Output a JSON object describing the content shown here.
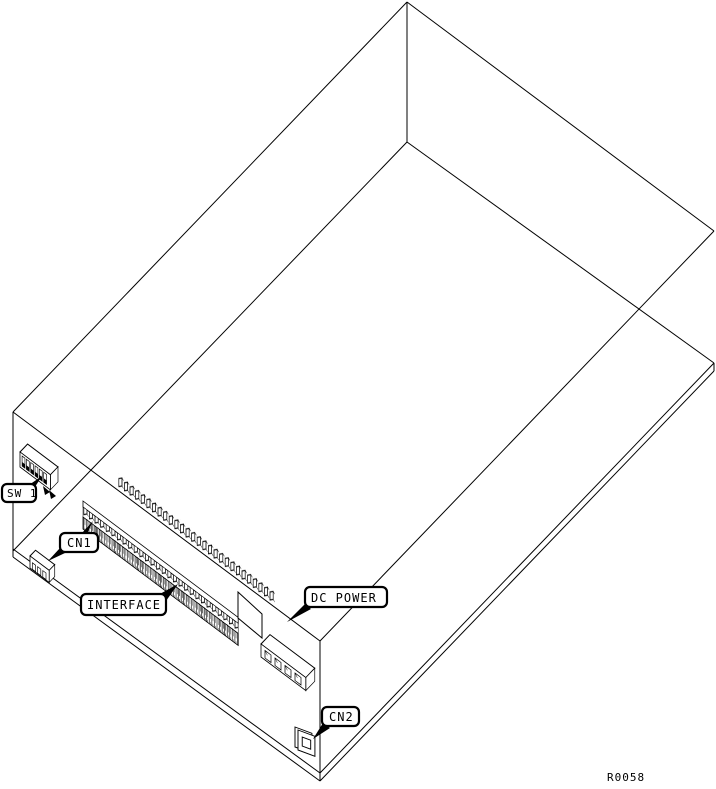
{
  "diagram": {
    "type": "technical-line-drawing",
    "subject": "circuit-board-enclosure-isometric-wireframe",
    "background_color": "#ffffff",
    "line_color": "#000000",
    "ref_number": "R0058",
    "labels": {
      "sw1": "SW 1",
      "cn1": "CN1",
      "interface": "INTERFACE",
      "dc_power": "DC POWER",
      "cn2": "CN2"
    },
    "components": [
      {
        "id": "sw1",
        "kind": "dip-switch"
      },
      {
        "id": "cn1",
        "kind": "4-pin-connector"
      },
      {
        "id": "interface",
        "kind": "card-edge-connector-with-pin-row"
      },
      {
        "id": "dc_power",
        "kind": "4-pin-power-connector"
      },
      {
        "id": "cn2",
        "kind": "small-panel-connector"
      }
    ]
  }
}
